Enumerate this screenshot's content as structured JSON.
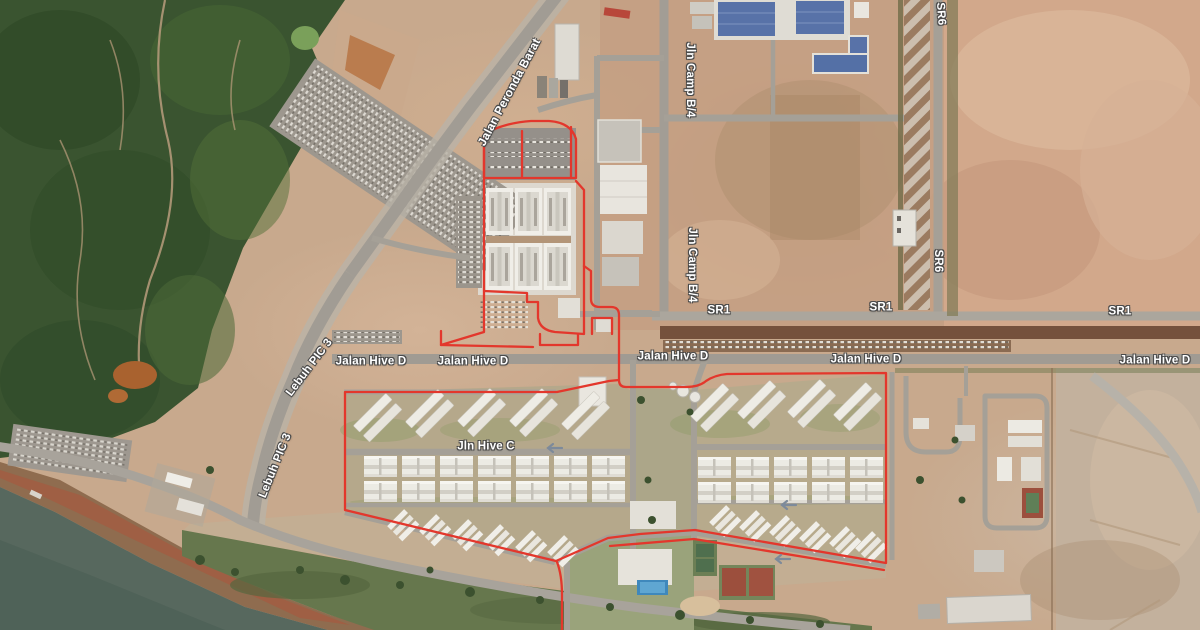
{
  "map": {
    "labels": {
      "peronda_barat": "Jalan Peronda Barat",
      "lebuh_pic_3": "Lebuh PIC 3",
      "camp_b4": "Jln Camp B/4",
      "sr6": "SR6",
      "sr1": "SR1",
      "hive_d": "Jalan Hive D",
      "hive_c": "Jln Hive C"
    },
    "colors": {
      "boundary_red": "#e3372c",
      "water": "#57685e",
      "forest": "#3a5430",
      "bare_earth": "#c8a98d",
      "road_gray": "#a5a097",
      "blue_roof": "#5872a8",
      "building_white": "#e9e6df",
      "label_text": "#ffffff",
      "label_outline": "#4a4a4a"
    }
  }
}
